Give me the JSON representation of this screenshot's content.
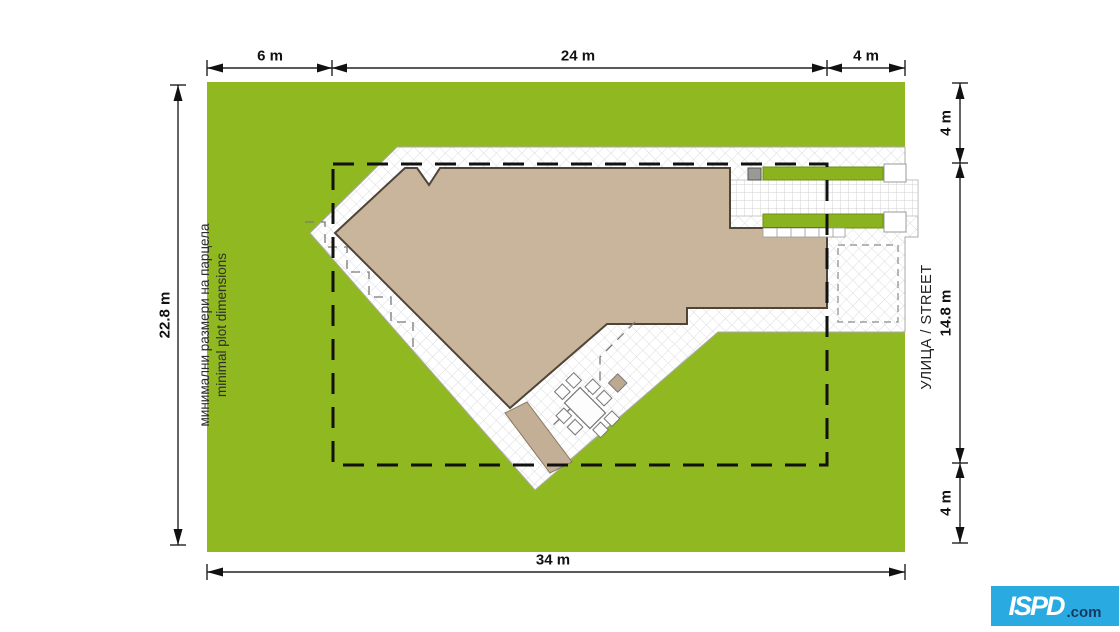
{
  "colors": {
    "plot_green": "#8FB821",
    "grass_strip_green": "#8AB31F",
    "roof_tan": "#C9B59B",
    "path_tan": "#C3AF95",
    "boundary_black": "#111111",
    "logo_blue": "#29ABE2"
  },
  "dimensions": {
    "top": {
      "left": "6 m",
      "middle": "24 m",
      "right": "4 m"
    },
    "bottom": {
      "total": "34 m"
    },
    "left": {
      "total": "22.8 m"
    },
    "right": {
      "top": "4 m",
      "middle": "14.8 m",
      "bottom": "4 m"
    }
  },
  "annotations": {
    "plot_note_line1": "минимални размери на парцела",
    "plot_note_line2": "minimal plot dimensions",
    "street_label": "УЛИЦА / STREET"
  },
  "logo": {
    "name": "ISPD",
    "suffix": ".com"
  }
}
